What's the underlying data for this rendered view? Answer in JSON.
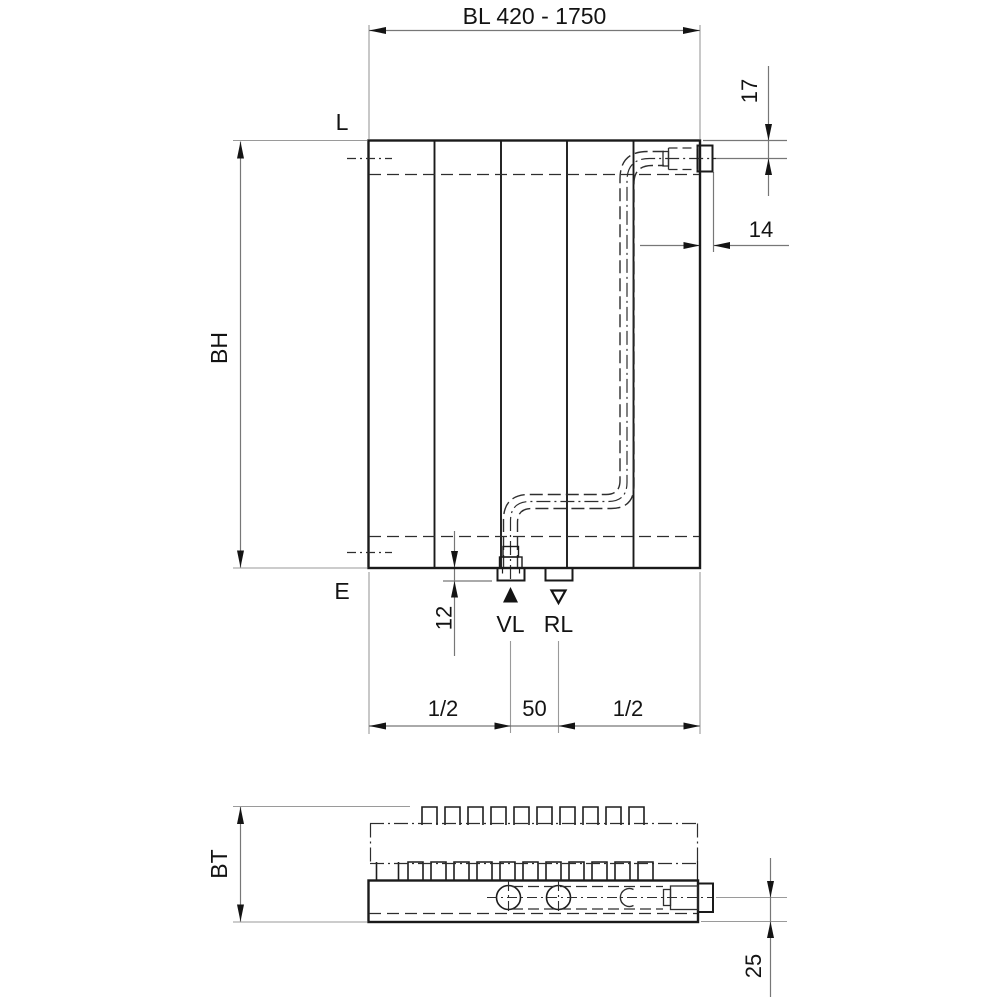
{
  "meta": {
    "background": "#ffffff",
    "object_line_color": "#1a1a1a",
    "dimension_line_color": "#777777",
    "extension_line_color": "#9a9a9a",
    "text_color": "#131313"
  },
  "front_view": {
    "overall_width_dim": "BL 420 - 1750",
    "overall_height_dim": "BH",
    "top_edge_label": "L",
    "bottom_edge_label": "E",
    "top_connection_offset_dim": "17",
    "side_connection_depth_dim": "14",
    "stub_protrusion_dim": "12",
    "supply_label": "VL",
    "return_label": "RL",
    "bottom_chain": {
      "left": "1/2",
      "center": "50",
      "right": "1/2"
    }
  },
  "bottom_view": {
    "depth_dim": "BT",
    "rear_pipe_offset_dim": "25"
  }
}
